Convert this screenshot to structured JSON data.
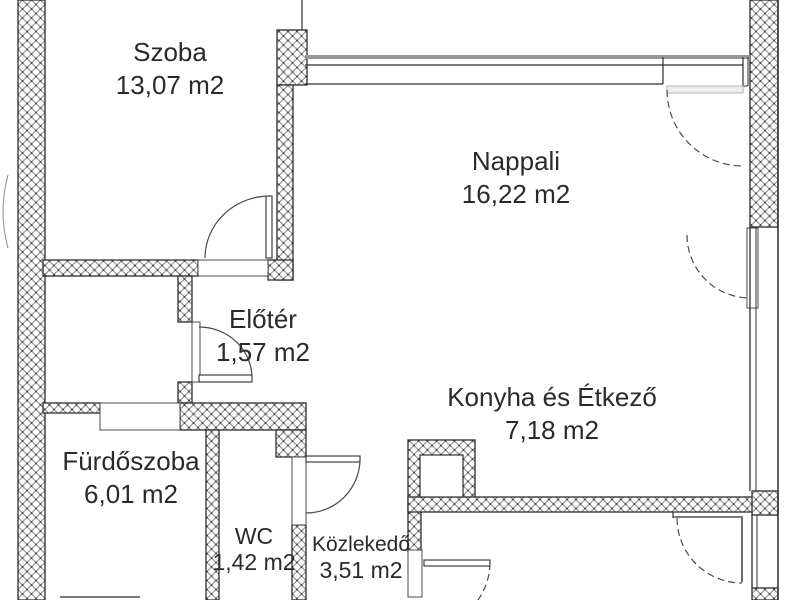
{
  "floorplan": {
    "type": "apartment-floor-plan",
    "area_unit": "m2",
    "rooms": [
      {
        "id": "szoba",
        "name": "Szoba",
        "area": "13,07 m2"
      },
      {
        "id": "nappali",
        "name": "Nappali",
        "area": "16,22 m2"
      },
      {
        "id": "eloter",
        "name": "Előtér",
        "area": "1,57 m2"
      },
      {
        "id": "konyha",
        "name": "Konyha és Étkező",
        "area": "7,18 m2"
      },
      {
        "id": "furdoszoba",
        "name": "Fürdőszoba",
        "area": "6,01 m2"
      },
      {
        "id": "wc",
        "name": "WC",
        "area": "1,42 m2"
      },
      {
        "id": "kozlekedo",
        "name": "Közlekedő",
        "area": "3,51 m2"
      }
    ],
    "colors": {
      "background": "#ffffff",
      "wall_hatch": "#8f8f8f",
      "wall_outline": "#2e2e2e",
      "window_band_gray": "#979797",
      "text": "#2a2a2a"
    }
  }
}
